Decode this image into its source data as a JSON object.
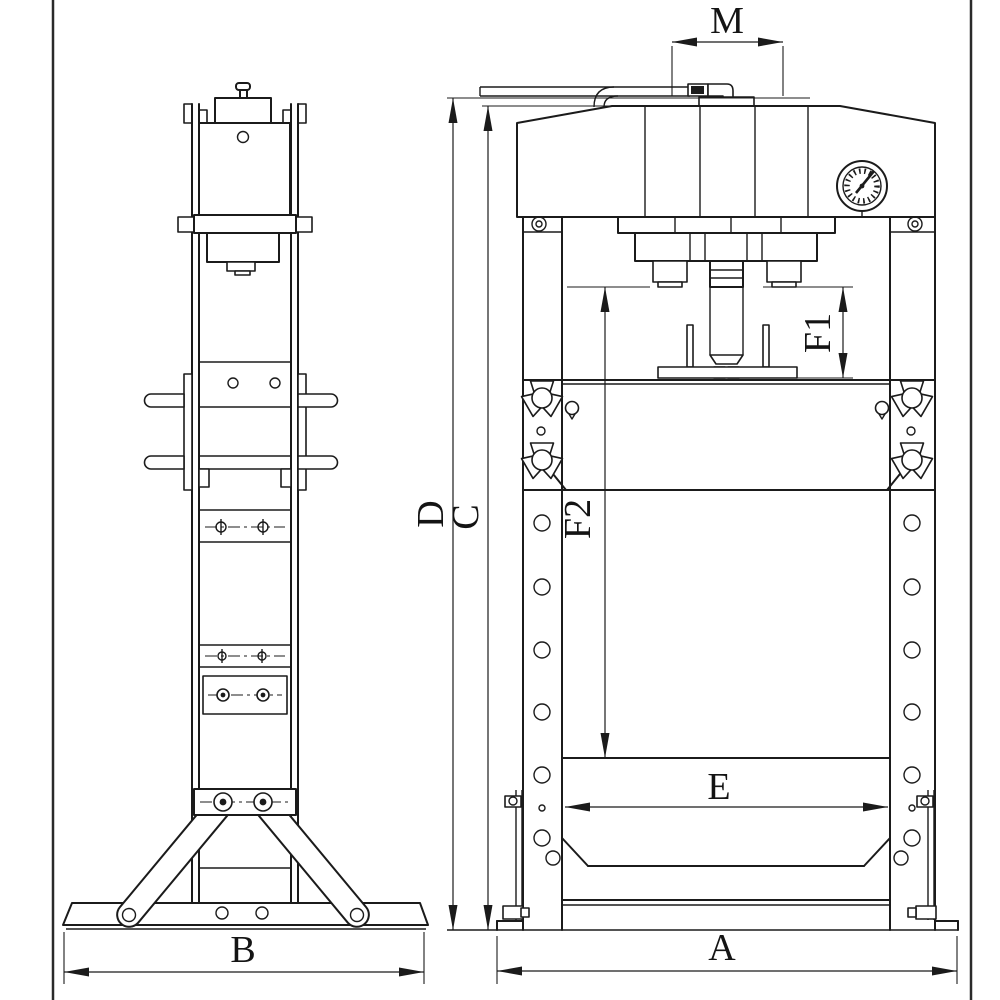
{
  "drawing": {
    "colors": {
      "background": "#ffffff",
      "line": "#1b1b1b"
    },
    "views": {
      "side": "side-view",
      "front": "front-view"
    },
    "dimensions": {
      "m": "M",
      "d": "D",
      "c": "C",
      "f1": "F1",
      "f2": "F2",
      "e": "E",
      "b": "B",
      "a": "A"
    }
  }
}
